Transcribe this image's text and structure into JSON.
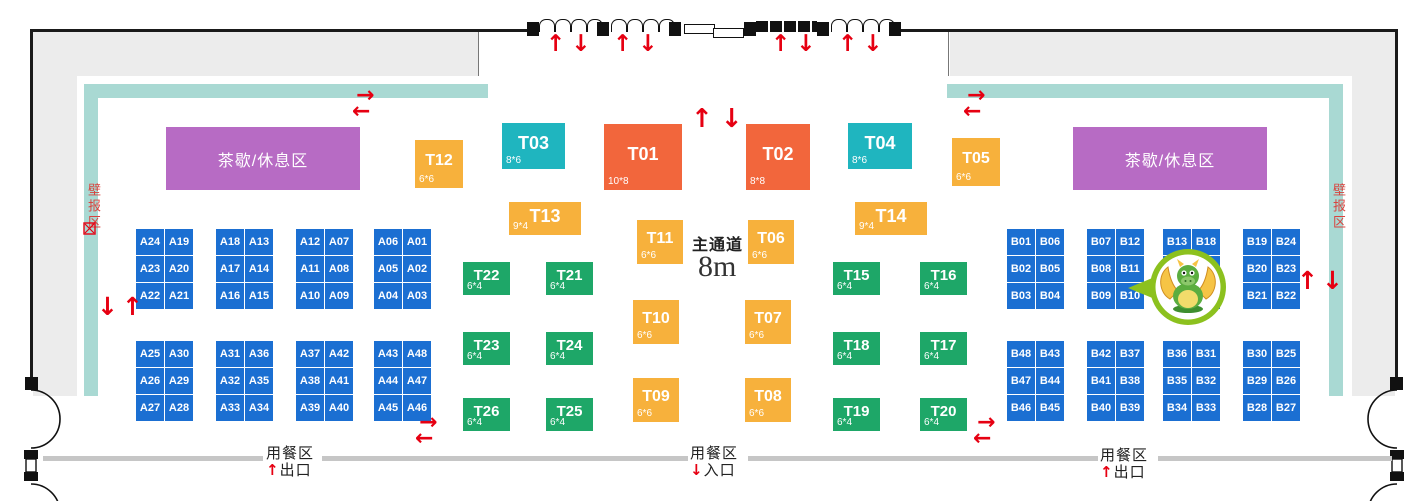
{
  "colors": {
    "orange": "#F2663C",
    "teal": "#1FB5BF",
    "yellow": "#F7B13C",
    "green": "#1EA768",
    "blue": "#1B6FD2",
    "purple": "#B76BC4",
    "band": "#A9D9D3",
    "red": "#E60012",
    "wall_gray": "#ECECEC",
    "divider_gray": "#C6C6C6"
  },
  "rest_areas": {
    "left": "茶歇/休息区",
    "right": "茶歇/休息区"
  },
  "poster_areas": {
    "left": "壁报区",
    "right": "壁报区"
  },
  "aisle": {
    "label": "主通道",
    "width": "8m"
  },
  "dining": {
    "left": {
      "zone": "用餐区",
      "arrow": "↑",
      "gate": "出口"
    },
    "center": {
      "zone": "用餐区",
      "arrow": "↓",
      "gate": "入口"
    },
    "right": {
      "zone": "用餐区",
      "arrow": "↑",
      "gate": "出口"
    }
  },
  "mascot": "dragon-mascot",
  "booths_t": [
    {
      "id": "T12",
      "label": "T12",
      "size": "6*6",
      "type": "yellow",
      "x": 415,
      "y": 140,
      "w": 48,
      "h": 48
    },
    {
      "id": "T03",
      "label": "T03",
      "size": "8*6",
      "type": "teal",
      "x": 502,
      "y": 123,
      "w": 63,
      "h": 46
    },
    {
      "id": "T01",
      "label": "T01",
      "size": "10*8",
      "type": "orange",
      "x": 604,
      "y": 124,
      "w": 78,
      "h": 66
    },
    {
      "id": "T02",
      "label": "T02",
      "size": "8*8",
      "type": "orange",
      "x": 746,
      "y": 124,
      "w": 64,
      "h": 66
    },
    {
      "id": "T04",
      "label": "T04",
      "size": "8*6",
      "type": "teal",
      "x": 848,
      "y": 123,
      "w": 64,
      "h": 46
    },
    {
      "id": "T05",
      "label": "T05",
      "size": "6*6",
      "type": "yellow",
      "x": 952,
      "y": 138,
      "w": 48,
      "h": 48
    },
    {
      "id": "T13",
      "label": "T13",
      "size": "9*4",
      "type": "yellow",
      "x": 509,
      "y": 202,
      "w": 72,
      "h": 33
    },
    {
      "id": "T14",
      "label": "T14",
      "size": "9*4",
      "type": "yellow",
      "x": 855,
      "y": 202,
      "w": 72,
      "h": 33
    },
    {
      "id": "T11",
      "label": "T11",
      "size": "6*6",
      "type": "yellow",
      "x": 637,
      "y": 220,
      "w": 46,
      "h": 44
    },
    {
      "id": "T06",
      "label": "T06",
      "size": "6*6",
      "type": "yellow",
      "x": 748,
      "y": 220,
      "w": 46,
      "h": 44
    },
    {
      "id": "T22",
      "label": "T22",
      "size": "6*4",
      "type": "green",
      "x": 463,
      "y": 262,
      "w": 47,
      "h": 33
    },
    {
      "id": "T21",
      "label": "T21",
      "size": "6*4",
      "type": "green",
      "x": 546,
      "y": 262,
      "w": 47,
      "h": 33
    },
    {
      "id": "T15",
      "label": "T15",
      "size": "6*4",
      "type": "green",
      "x": 833,
      "y": 262,
      "w": 47,
      "h": 33
    },
    {
      "id": "T16",
      "label": "T16",
      "size": "6*4",
      "type": "green",
      "x": 920,
      "y": 262,
      "w": 47,
      "h": 33
    },
    {
      "id": "T10",
      "label": "T10",
      "size": "6*6",
      "type": "yellow",
      "x": 633,
      "y": 300,
      "w": 46,
      "h": 44
    },
    {
      "id": "T07",
      "label": "T07",
      "size": "6*6",
      "type": "yellow",
      "x": 745,
      "y": 300,
      "w": 46,
      "h": 44
    },
    {
      "id": "T23",
      "label": "T23",
      "size": "6*4",
      "type": "green",
      "x": 463,
      "y": 332,
      "w": 47,
      "h": 33
    },
    {
      "id": "T24",
      "label": "T24",
      "size": "6*4",
      "type": "green",
      "x": 546,
      "y": 332,
      "w": 47,
      "h": 33
    },
    {
      "id": "T18",
      "label": "T18",
      "size": "6*4",
      "type": "green",
      "x": 833,
      "y": 332,
      "w": 47,
      "h": 33
    },
    {
      "id": "T17",
      "label": "T17",
      "size": "6*4",
      "type": "green",
      "x": 920,
      "y": 332,
      "w": 47,
      "h": 33
    },
    {
      "id": "T09",
      "label": "T09",
      "size": "6*6",
      "type": "yellow",
      "x": 633,
      "y": 378,
      "w": 46,
      "h": 44
    },
    {
      "id": "T08",
      "label": "T08",
      "size": "6*6",
      "type": "yellow",
      "x": 745,
      "y": 378,
      "w": 46,
      "h": 44
    },
    {
      "id": "T26",
      "label": "T26",
      "size": "6*4",
      "type": "green",
      "x": 463,
      "y": 398,
      "w": 47,
      "h": 33
    },
    {
      "id": "T25",
      "label": "T25",
      "size": "6*4",
      "type": "green",
      "x": 546,
      "y": 398,
      "w": 47,
      "h": 33
    },
    {
      "id": "T19",
      "label": "T19",
      "size": "6*4",
      "type": "green",
      "x": 833,
      "y": 398,
      "w": 47,
      "h": 33
    },
    {
      "id": "T20",
      "label": "T20",
      "size": "6*4",
      "type": "green",
      "x": 920,
      "y": 398,
      "w": 47,
      "h": 33
    }
  ],
  "booth_blocks": [
    {
      "id": "A-top-1",
      "x": 136,
      "y": 229,
      "rows": [
        [
          "A24",
          "A19"
        ],
        [
          "A23",
          "A20"
        ],
        [
          "A22",
          "A21"
        ]
      ]
    },
    {
      "id": "A-top-2",
      "x": 216,
      "y": 229,
      "rows": [
        [
          "A18",
          "A13"
        ],
        [
          "A17",
          "A14"
        ],
        [
          "A16",
          "A15"
        ]
      ]
    },
    {
      "id": "A-top-3",
      "x": 296,
      "y": 229,
      "rows": [
        [
          "A12",
          "A07"
        ],
        [
          "A11",
          "A08"
        ],
        [
          "A10",
          "A09"
        ]
      ]
    },
    {
      "id": "A-top-4",
      "x": 374,
      "y": 229,
      "rows": [
        [
          "A06",
          "A01"
        ],
        [
          "A05",
          "A02"
        ],
        [
          "A04",
          "A03"
        ]
      ]
    },
    {
      "id": "A-bot-1",
      "x": 136,
      "y": 341,
      "rows": [
        [
          "A25",
          "A30"
        ],
        [
          "A26",
          "A29"
        ],
        [
          "A27",
          "A28"
        ]
      ]
    },
    {
      "id": "A-bot-2",
      "x": 216,
      "y": 341,
      "rows": [
        [
          "A31",
          "A36"
        ],
        [
          "A32",
          "A35"
        ],
        [
          "A33",
          "A34"
        ]
      ]
    },
    {
      "id": "A-bot-3",
      "x": 296,
      "y": 341,
      "rows": [
        [
          "A37",
          "A42"
        ],
        [
          "A38",
          "A41"
        ],
        [
          "A39",
          "A40"
        ]
      ]
    },
    {
      "id": "A-bot-4",
      "x": 374,
      "y": 341,
      "rows": [
        [
          "A43",
          "A48"
        ],
        [
          "A44",
          "A47"
        ],
        [
          "A45",
          "A46"
        ]
      ]
    },
    {
      "id": "B-top-1",
      "x": 1007,
      "y": 229,
      "rows": [
        [
          "B01",
          "B06"
        ],
        [
          "B02",
          "B05"
        ],
        [
          "B03",
          "B04"
        ]
      ]
    },
    {
      "id": "B-top-2",
      "x": 1087,
      "y": 229,
      "rows": [
        [
          "B07",
          "B12"
        ],
        [
          "B08",
          "B11"
        ],
        [
          "B09",
          "B10"
        ]
      ]
    },
    {
      "id": "B-top-3",
      "x": 1163,
      "y": 229,
      "rows": [
        [
          "B13",
          "B18"
        ],
        [
          "",
          ""
        ],
        [
          "",
          ""
        ]
      ]
    },
    {
      "id": "B-top-4",
      "x": 1243,
      "y": 229,
      "rows": [
        [
          "B19",
          "B24"
        ],
        [
          "B20",
          "B23"
        ],
        [
          "B21",
          "B22"
        ]
      ]
    },
    {
      "id": "B-bot-1",
      "x": 1007,
      "y": 341,
      "rows": [
        [
          "B48",
          "B43"
        ],
        [
          "B47",
          "B44"
        ],
        [
          "B46",
          "B45"
        ]
      ]
    },
    {
      "id": "B-bot-2",
      "x": 1087,
      "y": 341,
      "rows": [
        [
          "B42",
          "B37"
        ],
        [
          "B41",
          "B38"
        ],
        [
          "B40",
          "B39"
        ]
      ]
    },
    {
      "id": "B-bot-3",
      "x": 1163,
      "y": 341,
      "rows": [
        [
          "B36",
          "B31"
        ],
        [
          "B35",
          "B32"
        ],
        [
          "B34",
          "B33"
        ]
      ]
    },
    {
      "id": "B-bot-4",
      "x": 1243,
      "y": 341,
      "rows": [
        [
          "B30",
          "B25"
        ],
        [
          "B29",
          "B26"
        ],
        [
          "B28",
          "B27"
        ]
      ]
    }
  ],
  "arrows": [
    {
      "g": "↑↓",
      "x": 546,
      "y": 33,
      "fs": 23,
      "sp": 6
    },
    {
      "g": "↑↓",
      "x": 613,
      "y": 33,
      "fs": 23,
      "sp": 6
    },
    {
      "g": "↑↓",
      "x": 771,
      "y": 33,
      "fs": 23,
      "sp": 6
    },
    {
      "g": "↑↓",
      "x": 838,
      "y": 33,
      "fs": 23,
      "sp": 6
    },
    {
      "g": "↑↓",
      "x": 691,
      "y": 106,
      "fs": 26,
      "sp": 8
    },
    {
      "g": "→",
      "x": 356,
      "y": 85,
      "fs": 22,
      "sp": 0
    },
    {
      "g": "←",
      "x": 352,
      "y": 101,
      "fs": 22,
      "sp": 0
    },
    {
      "g": "→",
      "x": 967,
      "y": 85,
      "fs": 22,
      "sp": 0
    },
    {
      "g": "←",
      "x": 963,
      "y": 101,
      "fs": 22,
      "sp": 0
    },
    {
      "g": "↓↑",
      "x": 97,
      "y": 294,
      "fs": 25,
      "sp": 4
    },
    {
      "g": "↑↓",
      "x": 1297,
      "y": 268,
      "fs": 25,
      "sp": 4
    },
    {
      "g": "→",
      "x": 419,
      "y": 412,
      "fs": 22,
      "sp": 0
    },
    {
      "g": "←",
      "x": 415,
      "y": 428,
      "fs": 22,
      "sp": 0
    },
    {
      "g": "→",
      "x": 977,
      "y": 412,
      "fs": 22,
      "sp": 0
    },
    {
      "g": "←",
      "x": 973,
      "y": 428,
      "fs": 22,
      "sp": 0
    }
  ]
}
